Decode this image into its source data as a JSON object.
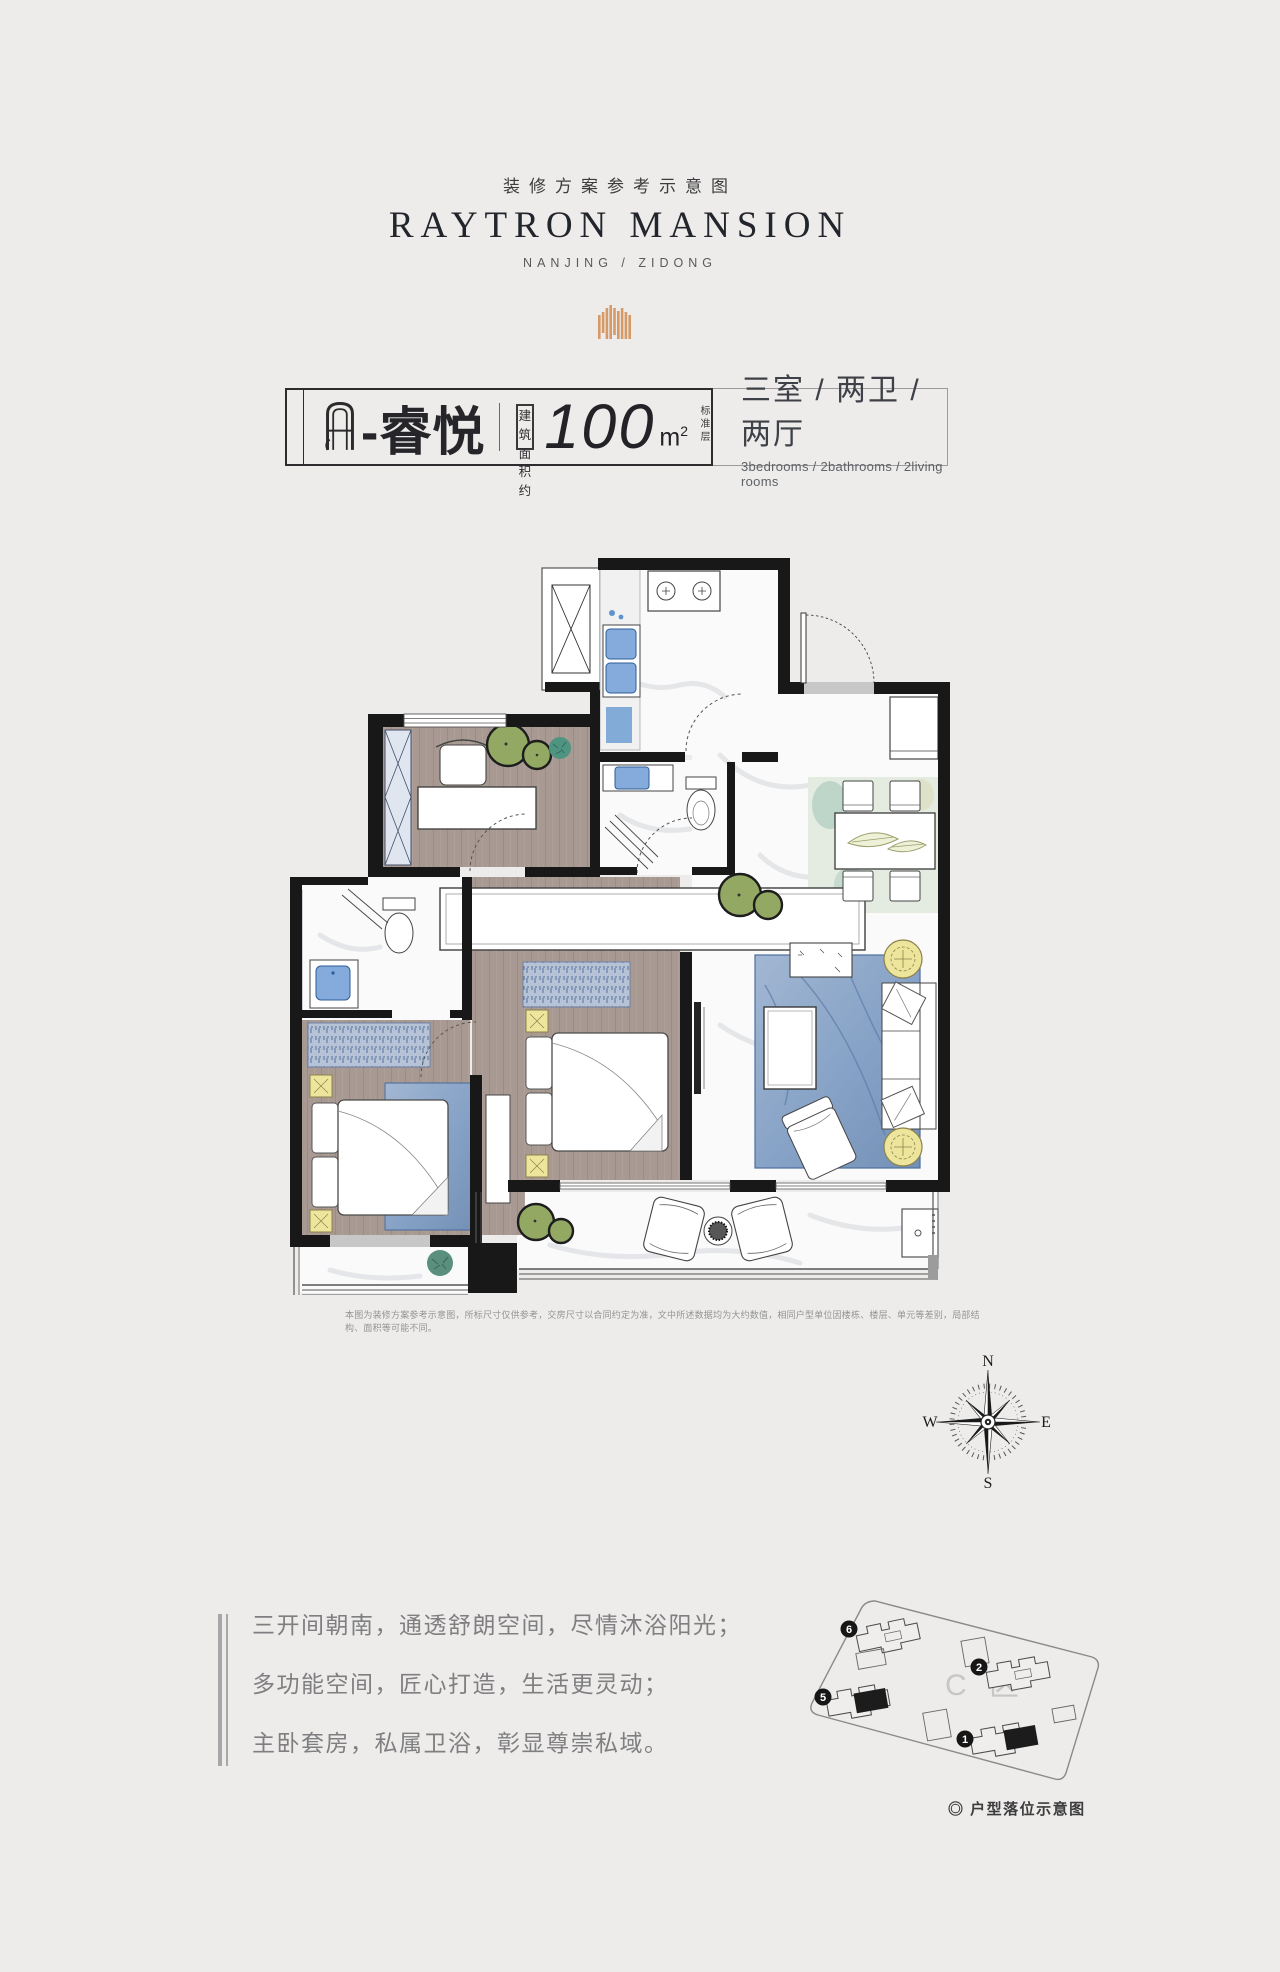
{
  "colors": {
    "bg": "#edecea",
    "accent": "#d69a68",
    "wall": "#181818",
    "fixture-blue": "#84abdc",
    "rug-blue": "#8ca7c8",
    "plant-olive": "#93a963",
    "nightstand-yellow": "#ede59c"
  },
  "header": {
    "subtitle": "装修方案参考示意图",
    "title": "RAYTRON MANSION",
    "location": "NANJING / ZIDONG",
    "logo_icon": "striped-emblem"
  },
  "titlebar": {
    "monogram": "A",
    "unit_name": "-睿悦",
    "area_box_line1": "建 筑",
    "area_box_line2": "面积约",
    "area_value": "100",
    "area_unit_base": "m",
    "area_unit_sup": "2",
    "floor_note": "标准层",
    "rooms_cn": "三室 / 两卫 / 两厅",
    "rooms_en": "3bedrooms / 2bathrooms / 2living rooms"
  },
  "floorplan": {
    "elements": [
      "equipment-platform",
      "kitchen",
      "entry-door",
      "foyer",
      "dining-area",
      "guest-bathroom",
      "study-room",
      "master-ensuite",
      "master-bedroom",
      "second-bedroom",
      "living-room",
      "south-balcony",
      "master-balcony"
    ]
  },
  "disclaimer": "本图为装修方案参考示意图，所标尺寸仅供参考，交房尺寸以合同约定为准，文中所述数据均为大约数值，相同户型单位因楼栋、楼层、单元等差别，局部结构、面积等可能不同。",
  "compass": {
    "n": "N",
    "e": "E",
    "s": "S",
    "w": "W"
  },
  "selling_points": [
    "三开间朝南，通透舒朗空间，尽情沐浴阳光；",
    "多功能空间，匠心打造，生活更灵动；",
    "主卧套房，私属卫浴，彰显尊崇私域。"
  ],
  "siteplan": {
    "zone_label": "C 区",
    "buildings": [
      {
        "num": "6"
      },
      {
        "num": "2"
      },
      {
        "num": "5"
      },
      {
        "num": "1"
      }
    ],
    "caption": "◎ 户型落位示意图"
  }
}
